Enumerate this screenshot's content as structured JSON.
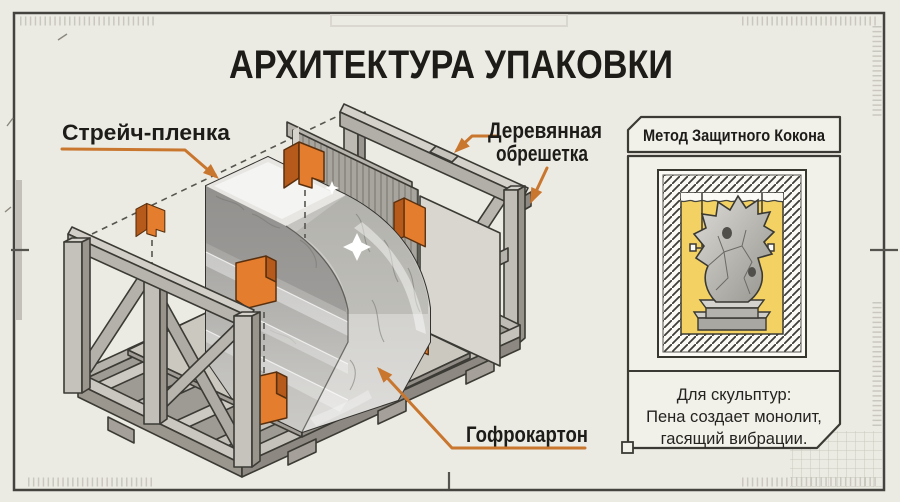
{
  "title": "АРХИТЕКТУРА УПАКОВКИ",
  "diagram": {
    "labels": {
      "stretch_film": "Стрейч-пленка",
      "wooden_crate_line1": "Деревянная",
      "wooden_crate_line2": "обрешетка",
      "cardboard": "Гофрокартон"
    }
  },
  "side_panel": {
    "header": "Метод Защитного Кокона",
    "caption": {
      "line1": "Для скульптур:",
      "line2": "Пена создает монолит,",
      "line3": "гасящий вибрации."
    }
  },
  "colors": {
    "accent_orange": "#c9762f",
    "protector_orange": "#e57d2e",
    "foam_yellow": "#f3d263",
    "paper": "#ecebe3",
    "ink": "#1d1c18"
  }
}
